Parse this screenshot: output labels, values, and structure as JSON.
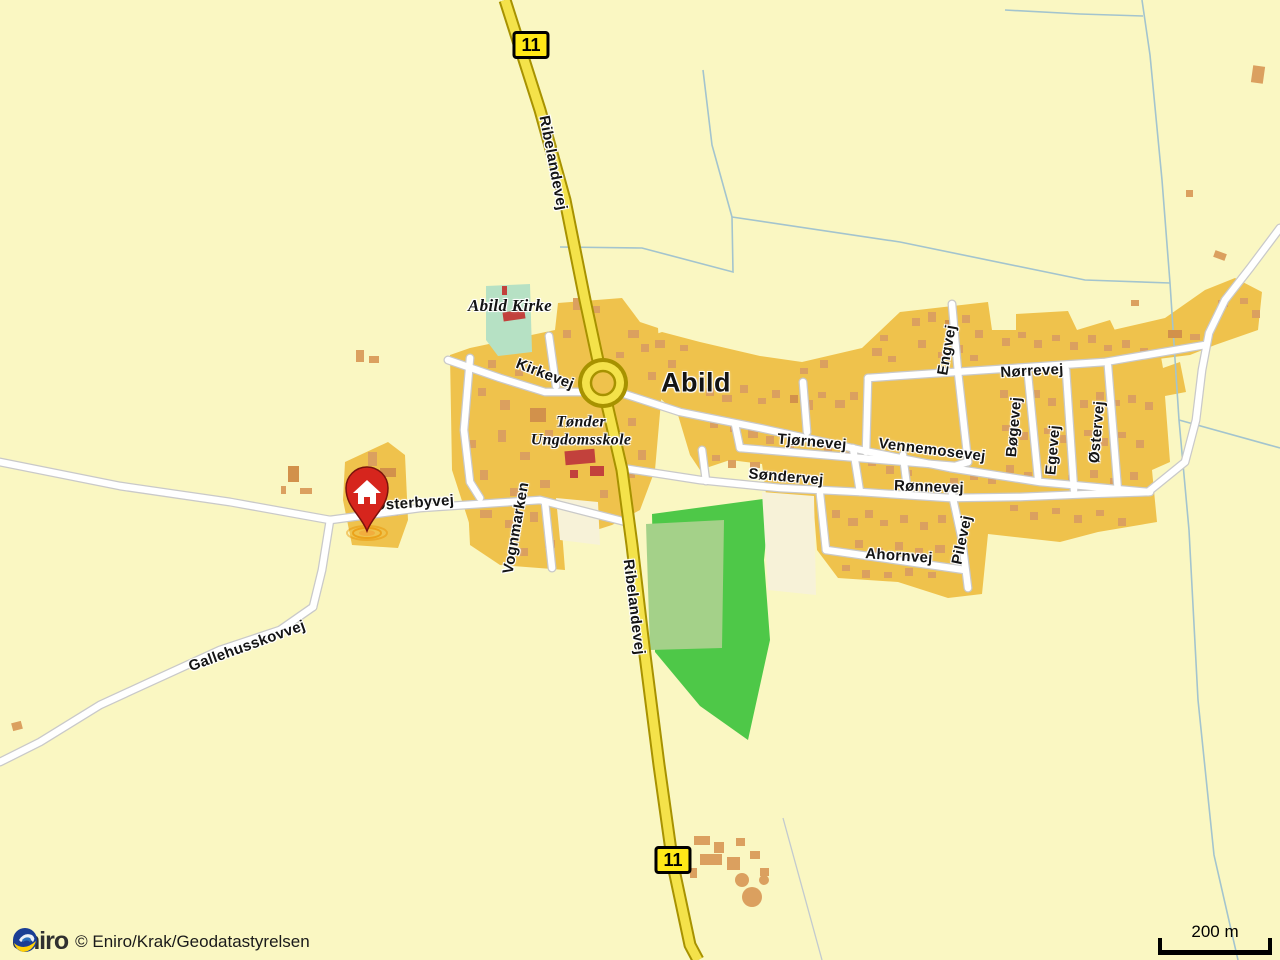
{
  "map": {
    "town_label": "Abild",
    "route_number": "11",
    "highway_label": "Ribelandevej",
    "pois": {
      "church": "Abild Kirke",
      "school_line1": "Tønder",
      "school_line2": "Ungdomsskole"
    },
    "streets": {
      "kirkevej": "Kirkevej",
      "osterbyvej": "Østerbyvej",
      "vognmarken": "Vognmarken",
      "gallehusskovvej": "Gallehusskovvej",
      "tjornevej": "Tjørnevej",
      "sondervej": "Søndervej",
      "vennemosevej": "Vennemosevej",
      "ronnevej": "Rønnevej",
      "ahornvej": "Ahornvej",
      "pilevej": "Pilevej",
      "engvej": "Engvej",
      "norrevej": "Nørrevej",
      "bogevej": "Bøgevej",
      "egevej": "Egevej",
      "ostervej": "Østervej"
    }
  },
  "icons": {
    "marker": "home-pin-icon",
    "logo": "eniro-swirl-icon"
  },
  "attribution": {
    "logo_text": "eniro",
    "copyright": "© Eniro/Krak/Geodatastyrelsen"
  },
  "scale_bar": {
    "label": "200 m"
  },
  "colors": {
    "bg": "#FAF7C2",
    "town": "#EFC24C",
    "bldg": "#DBA05F",
    "bldg_dark": "#D2914B",
    "red": "#C2413C",
    "church_green": "#B6E1C4",
    "forest": "#4EC848",
    "field": "#A4D189",
    "cream": "#F7F2D8",
    "road_fill": "#FFFFFF",
    "road_casing": "#C9C9C9",
    "hwy_fill": "#F4E24A",
    "hwy_casing": "#A79200",
    "badge": "#FFE817",
    "stream": "#A3C4CE",
    "label": "#141414"
  }
}
